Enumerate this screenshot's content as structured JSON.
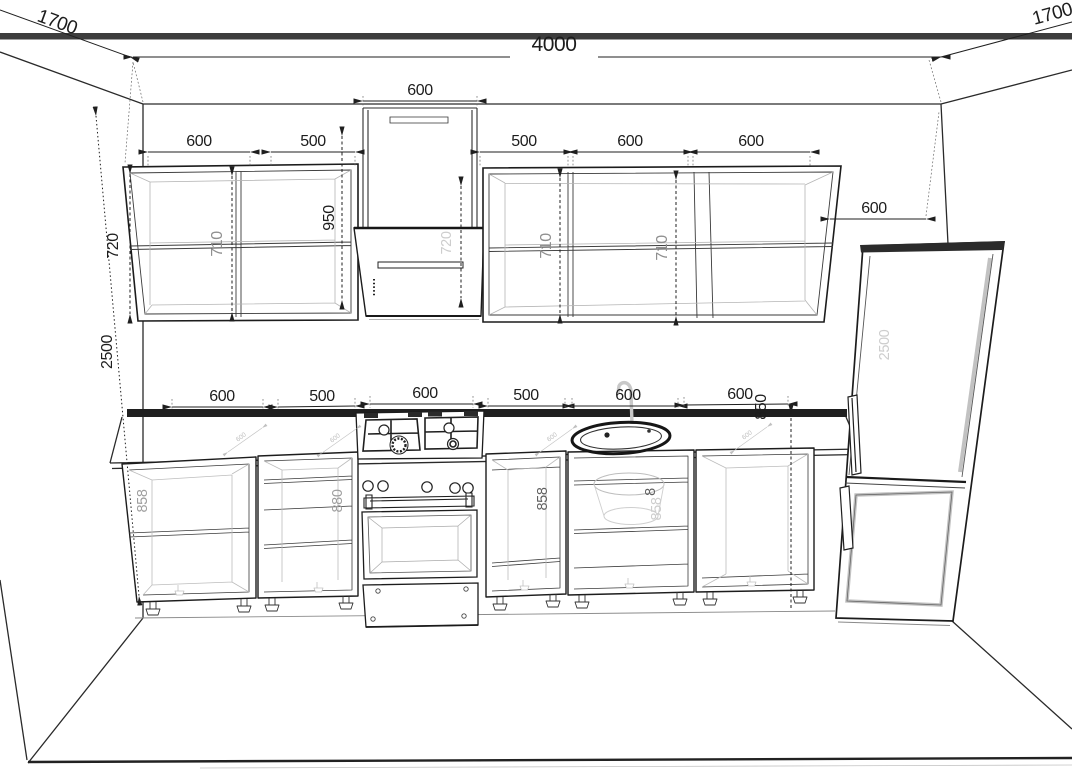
{
  "dims": {
    "room": {
      "width": "4000",
      "height": "2500",
      "left_depth": "1700",
      "right_depth": "1700"
    },
    "upper": {
      "duct": "600",
      "left1": "600",
      "left2": "500",
      "right1": "500",
      "right2": "600",
      "right3": "600",
      "carcass": "720",
      "int1": "710",
      "int2": "710",
      "int3": "710",
      "hood": "720",
      "clearance": "950"
    },
    "counter": {
      "c1": "600",
      "c2": "500",
      "c3": "600",
      "c4": "500",
      "c5": "600",
      "c6": "600",
      "worktop": "850",
      "d1": "600",
      "d2": "600",
      "d3": "600",
      "d4": "600"
    },
    "base": {
      "h1": "858",
      "h2": "880",
      "h3": "858",
      "h4a": "8",
      "h4b": "858"
    },
    "fridge": {
      "depth": "600",
      "height": "2500"
    }
  }
}
